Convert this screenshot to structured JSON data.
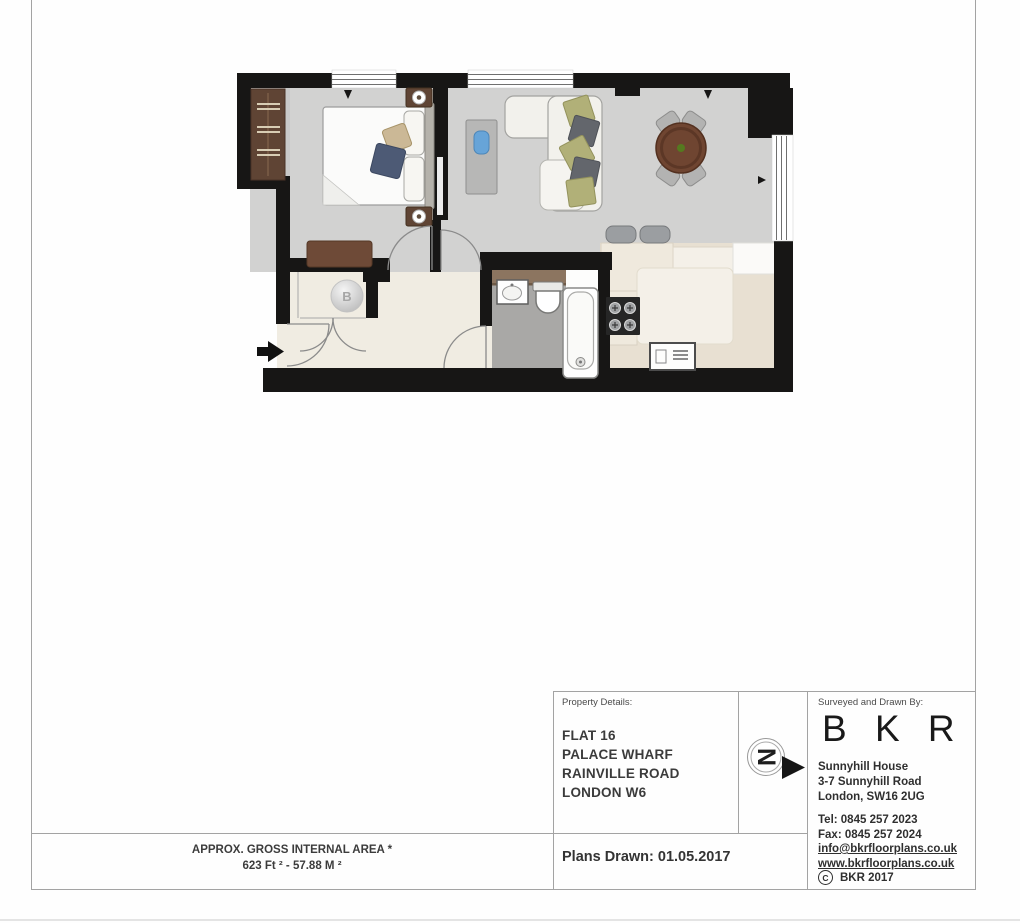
{
  "floorplan": {
    "boiler_label": "B",
    "compass_letter": "N"
  },
  "area_summary": {
    "line1": "APPROX. GROSS INTERNAL AREA *",
    "line2": "623 Ft ²  -  57.88 M ²"
  },
  "property_details": {
    "label": "Property Details:",
    "lines": [
      "FLAT 16",
      "PALACE WHARF",
      "RAINVILLE ROAD",
      "LONDON W6"
    ],
    "plans_drawn": "Plans Drawn: 01.05.2017"
  },
  "surveyor": {
    "label": "Surveyed and Drawn By:",
    "name": "B K R",
    "address_lines": [
      "Sunnyhill House",
      "3-7 Sunnyhill Road",
      "London, SW16 2UG"
    ],
    "tel": "Tel:  0845 257 2023",
    "fax": "Fax: 0845 257 2024",
    "email": "info@bkrfloorplans.co.uk",
    "website": "www.bkrfloorplans.co.uk",
    "copyright_symbol": "C",
    "copyright_text": "BKR 2017"
  },
  "colors": {
    "wall": "#171615",
    "floor-gray": "#d2d2d1",
    "floor-cream": "#f0ece2",
    "floor-kitchen": "#e8e0d2",
    "floor-bath": "#a9a8a6",
    "wood-dark": "#5f4434",
    "wood-mid": "#6e4a37",
    "table-brown": "#6f4531",
    "cushion-olive": "#b1b078",
    "cushion-gray": "#63666c",
    "line-gray": "#a3a3a3",
    "text-dark": "#3a3a3a"
  }
}
